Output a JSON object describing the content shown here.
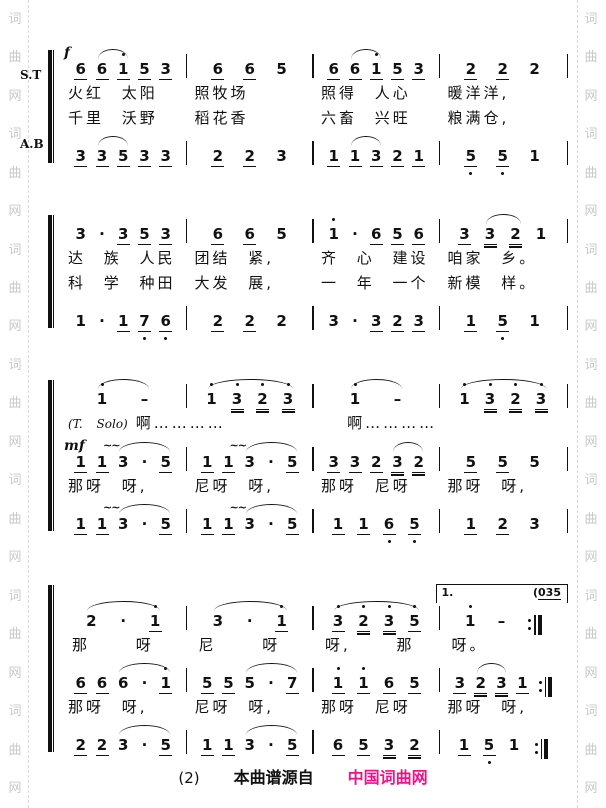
{
  "watermark": {
    "chars": [
      "词",
      "曲",
      "网"
    ],
    "repeat": 7,
    "color": "#c9c9c9"
  },
  "glyphs": {
    "mordent": "~~"
  },
  "footer": {
    "page_num": "(2)",
    "source_label": "本曲谱源自",
    "brand": "中国词曲网",
    "brand_color": "#ee1289"
  },
  "systems": [
    {
      "labels": [
        "S.T",
        "A.B"
      ],
      "rows": [
        {
          "kind": "notes",
          "dyn": "f",
          "end": "bar",
          "measures": [
            {
              "tk": [
                "6_",
                "6_",
                "1'_",
                "5_",
                "3_"
              ],
              "arcs": [
                [
                  1,
                  2
                ]
              ]
            },
            {
              "tk": [
                "6_",
                "6_",
                "5"
              ]
            },
            {
              "tk": [
                "6_",
                "6_",
                "1'_",
                "5_",
                "3_"
              ],
              "arcs": [
                [
                  1,
                  2
                ]
              ]
            },
            {
              "tk": [
                "2_",
                "2_",
                "2"
              ]
            }
          ]
        },
        {
          "kind": "lyrics",
          "cells": [
            "火红 太阳",
            "照牧场",
            "照得 人心",
            "暖洋洋,"
          ]
        },
        {
          "kind": "lyrics",
          "cells": [
            "千里 沃野",
            "稻花香",
            "六畜 兴旺",
            "粮满仓,"
          ]
        },
        {
          "kind": "notes",
          "end": "bar",
          "measures": [
            {
              "tk": [
                "3_",
                "3_",
                "5_",
                "3_",
                "3_"
              ],
              "arcs": [
                [
                  1,
                  2
                ]
              ]
            },
            {
              "tk": [
                "2_",
                "2_",
                "3"
              ]
            },
            {
              "tk": [
                "1_",
                "1_",
                "3_",
                "2_",
                "1_"
              ],
              "arcs": [
                [
                  1,
                  2
                ]
              ]
            },
            {
              "tk": [
                "5,_",
                "5,_",
                "1"
              ]
            }
          ]
        }
      ]
    },
    {
      "rows": [
        {
          "kind": "notes",
          "end": "bar",
          "measures": [
            {
              "tk": [
                "3",
                ".",
                "3_",
                "5_",
                "3_"
              ]
            },
            {
              "tk": [
                "6_",
                "6_",
                "5"
              ]
            },
            {
              "tk": [
                "1'",
                ".",
                "6_",
                "5_",
                "6_"
              ]
            },
            {
              "tk": [
                "3_",
                "3=",
                "2=",
                "1"
              ],
              "arcs": [
                [
                  1,
                  2
                ]
              ]
            }
          ]
        },
        {
          "kind": "lyrics",
          "cells": [
            "达 族 人民",
            "团结 紧,",
            "齐 心 建设",
            "咱家 乡。"
          ]
        },
        {
          "kind": "lyrics",
          "cells": [
            "科 学 种田",
            "大发 展,",
            "一 年 一个",
            "新模 样。"
          ]
        },
        {
          "kind": "notes",
          "end": "bar",
          "measures": [
            {
              "tk": [
                "1",
                ".",
                "1_",
                "7,_",
                "6,_"
              ]
            },
            {
              "tk": [
                "2_",
                "2_",
                "2"
              ]
            },
            {
              "tk": [
                "3",
                ".",
                "3_",
                "2_",
                "3_"
              ]
            },
            {
              "tk": [
                "1_",
                "5,_",
                "1"
              ]
            }
          ]
        }
      ]
    },
    {
      "rows": [
        {
          "kind": "notes",
          "end": "bar",
          "measures": [
            {
              "tk": [
                "1'",
                "-"
              ],
              "arcs": [
                [
                  0,
                  1
                ]
              ]
            },
            {
              "tk": [
                "1'",
                "3'=",
                "2'=",
                "3'="
              ],
              "arcs": [
                [
                  0,
                  3
                ]
              ]
            },
            {
              "tk": [
                "1'",
                "-"
              ],
              "arcs": [
                [
                  0,
                  1
                ]
              ]
            },
            {
              "tk": [
                "1'",
                "3'=",
                "2'=",
                "3'="
              ],
              "arcs": [
                [
                  0,
                  3
                ]
              ]
            }
          ]
        },
        {
          "kind": "lyrics",
          "prefix": "(T. Solo)",
          "cells": [
            "啊…………",
            "",
            "啊…………",
            ""
          ]
        },
        {
          "kind": "notes",
          "dyn": "mf",
          "end": "bar",
          "measures": [
            {
              "tk": [
                "1_",
                "1_",
                "3",
                ".",
                "5_"
              ],
              "arcs": [
                [
                  2,
                  4
                ]
              ],
              "mord": [
                2
              ]
            },
            {
              "tk": [
                "1_",
                "1_",
                "3",
                ".",
                "5_"
              ],
              "arcs": [
                [
                  2,
                  4
                ]
              ],
              "mord": [
                2
              ]
            },
            {
              "tk": [
                "3_",
                "3_",
                "2_",
                "3=",
                "2="
              ],
              "arcs": [
                [
                  3,
                  4
                ]
              ]
            },
            {
              "tk": [
                "5_",
                "5_",
                "5"
              ]
            }
          ]
        },
        {
          "kind": "lyrics",
          "cells": [
            "那呀 呀,",
            "尼呀 呀,",
            "那呀 尼呀",
            "那呀 呀,"
          ]
        },
        {
          "kind": "notes",
          "end": "bar",
          "measures": [
            {
              "tk": [
                "1_",
                "1_",
                "3",
                ".",
                "5_"
              ],
              "arcs": [
                [
                  2,
                  4
                ]
              ],
              "mord": [
                2
              ]
            },
            {
              "tk": [
                "1_",
                "1_",
                "3",
                ".",
                "5_"
              ],
              "arcs": [
                [
                  2,
                  4
                ]
              ],
              "mord": [
                2
              ]
            },
            {
              "tk": [
                "1_",
                "1_",
                "6,_",
                "5,_"
              ]
            },
            {
              "tk": [
                "1_",
                "2_",
                "3"
              ]
            }
          ]
        }
      ]
    },
    {
      "rows": [
        {
          "kind": "notes",
          "measures": [
            {
              "tk": [
                "2",
                ".",
                "1'_"
              ],
              "arcs": [
                [
                  0,
                  2
                ]
              ]
            },
            {
              "tk": [
                "3",
                ".",
                "1'_"
              ],
              "arcs": [
                [
                  0,
                  2
                ]
              ]
            },
            {
              "tk": [
                "3'_",
                "2'=",
                "3'=",
                "5'_"
              ],
              "arcs": [
                [
                  0,
                  3
                ]
              ]
            },
            {
              "tk": [
                "1'",
                "-"
              ],
              "repeat": true,
              "volta": {
                "label": "1.",
                "prefix": "(",
                "note": "035"
              }
            }
          ]
        },
        {
          "kind": "lyrics",
          "wide": true,
          "cells": [
            "那 呀",
            "尼 呀",
            "呀, 那",
            "呀。"
          ]
        },
        {
          "kind": "notes",
          "measures": [
            {
              "tk": [
                "6_",
                "6_",
                "6",
                ".",
                "1'_"
              ],
              "arcs": [
                [
                  2,
                  4
                ]
              ]
            },
            {
              "tk": [
                "5_",
                "5_",
                "5",
                ".",
                "7_"
              ],
              "arcs": [
                [
                  2,
                  4
                ]
              ]
            },
            {
              "tk": [
                "1'_",
                "1'_",
                "6_",
                "5_"
              ]
            },
            {
              "tk": [
                "3_",
                "2=",
                "3=",
                "1_"
              ],
              "arcs": [
                [
                  1,
                  2
                ]
              ],
              "repeat": true
            }
          ]
        },
        {
          "kind": "lyrics",
          "cells": [
            "那呀 呀,",
            "尼呀 呀,",
            "那呀 尼呀",
            "那呀 呀,"
          ]
        },
        {
          "kind": "notes",
          "measures": [
            {
              "tk": [
                "2_",
                "2_",
                "3",
                ".",
                "5_"
              ],
              "arcs": [
                [
                  2,
                  4
                ]
              ]
            },
            {
              "tk": [
                "1_",
                "1_",
                "3",
                ".",
                "5_"
              ],
              "arcs": [
                [
                  2,
                  4
                ]
              ]
            },
            {
              "tk": [
                "6_",
                "5_",
                "3=",
                "2="
              ]
            },
            {
              "tk": [
                "1_",
                "5,_",
                "1"
              ],
              "repeat": true
            }
          ]
        }
      ]
    }
  ]
}
